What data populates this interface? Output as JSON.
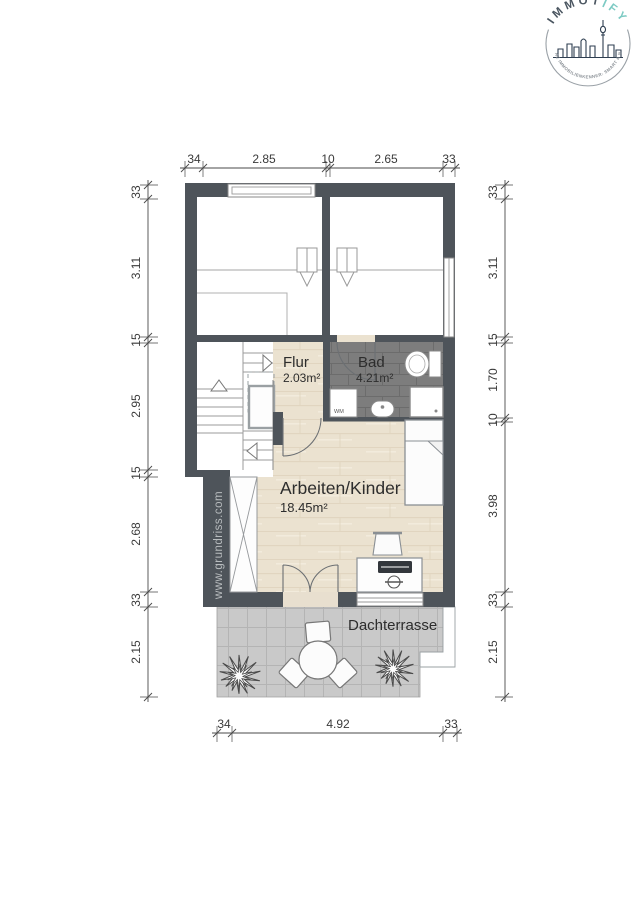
{
  "logo": {
    "brand_prefix": "IMMOT",
    "brand_suffix": "IFY",
    "tagline": "DEINE IMMOBILIENKENNER: SMART & NAH",
    "accent_color": "#7ccac3",
    "dark_color": "#4a5560"
  },
  "watermark": {
    "text": "www.grundriss.com"
  },
  "rooms": {
    "flur": {
      "name": "Flur",
      "area": "2.03m²"
    },
    "bad": {
      "name": "Bad",
      "area": "4.21m²"
    },
    "arbeiten": {
      "name": "Arbeiten/Kinder",
      "area": "18.45m²"
    },
    "terrasse": {
      "name": "Dachterrasse"
    }
  },
  "fixtures": {
    "washing_machine_label": "WM"
  },
  "dimensions": {
    "top": [
      "34",
      "2.85",
      "10",
      "2.65",
      "33"
    ],
    "bottom": [
      "34",
      "4.92",
      "33"
    ],
    "left": [
      "33",
      "3.11",
      "15",
      "2.95",
      "15",
      "2.68",
      "33",
      "2.15"
    ],
    "right": [
      "33",
      "3.11",
      "15",
      "1.70",
      "10",
      "3.98",
      "33",
      "2.15"
    ]
  },
  "colors": {
    "wall": "#4e545a",
    "wood_floor": "#ebe2d0",
    "bath_tile": "#7d7d7d",
    "terrace_tile": "#c9c9c9"
  }
}
